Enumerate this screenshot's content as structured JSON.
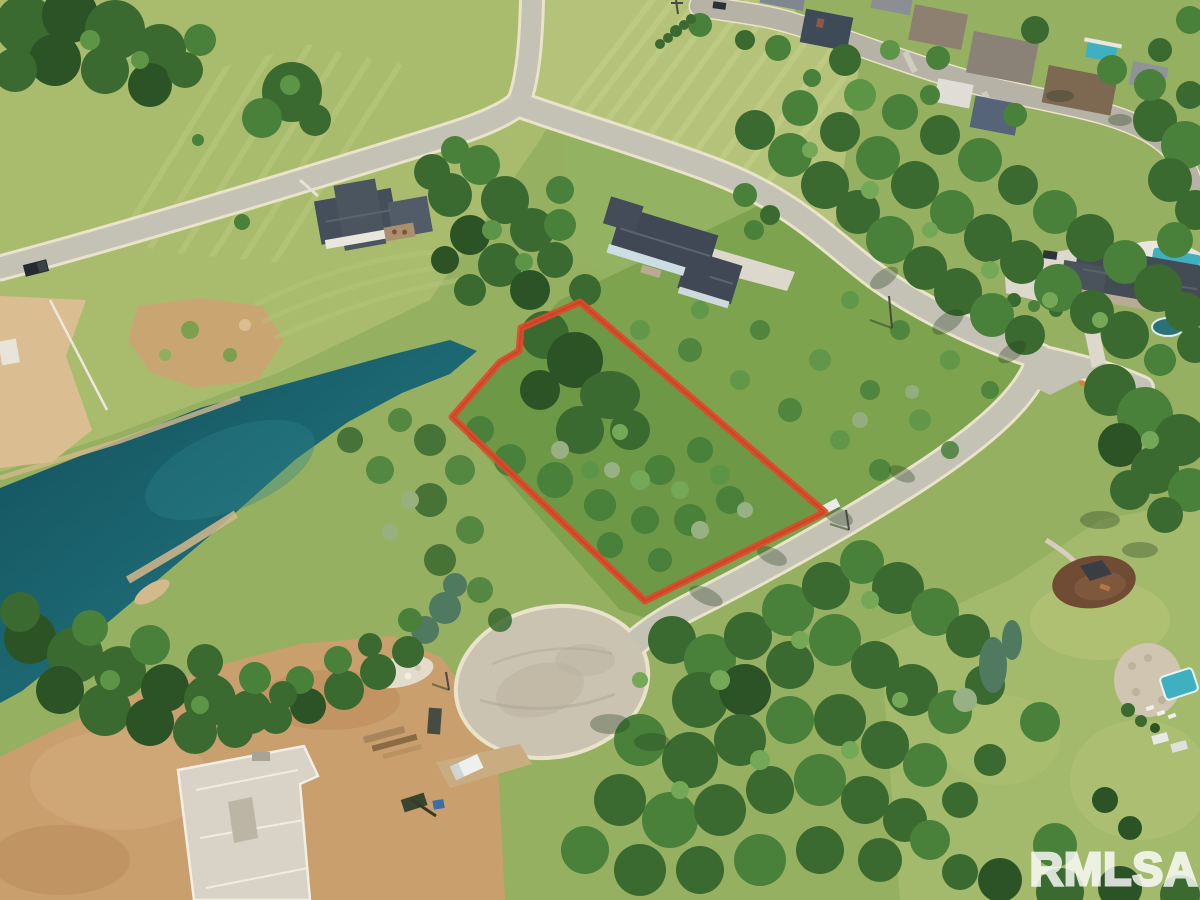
{
  "image": {
    "kind": "aerial-drone-real-estate-photo",
    "watermark": {
      "text": "RMLSA",
      "color": "#ffffff",
      "opacity": "0.8"
    }
  },
  "lot": {
    "boundary_points": "580,302 521,328 519,351 500,362 452,417 645,601 825,512",
    "boundary_color": "#df4a2d",
    "fill": "#6d9845"
  },
  "colors": {
    "field_base": "#96b062",
    "field_light": "#b5c37a",
    "field_tl": "#a9bc6e",
    "meadow": "#7da34f",
    "lawn_right": "#a3ba6c",
    "road_asphalt": "#c4c1b5",
    "road_edge_line": "#e8e3c9",
    "culdesac": "#cac3b2",
    "dirt": "#c99f6e",
    "dirt_light": "#dbbd92",
    "pond_deep": "#124f5a",
    "pond_mid": "#1d6a74",
    "pond_light": "#2f858d",
    "shore_sand": "#d4b98c",
    "roof_slate": "#3f4854",
    "wall_white": "#e9e6dd",
    "pool_teal": "#3fb0bf",
    "concrete": "#d8d3c6"
  }
}
